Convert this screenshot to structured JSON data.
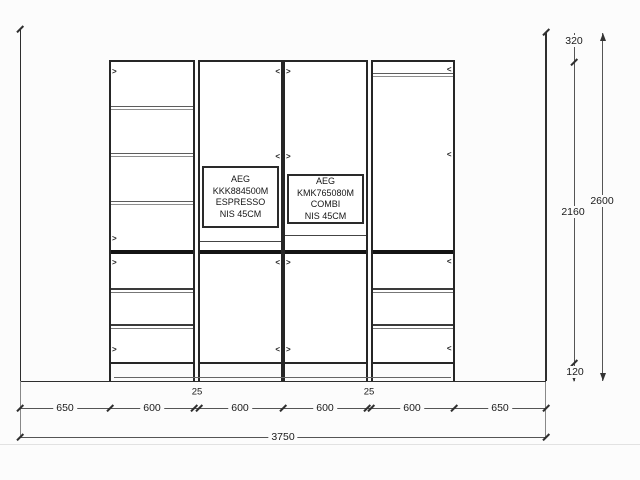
{
  "drawing_type": "kitchen-tall-cabinet-elevation",
  "appliances": [
    {
      "model": "AEG KKK884500M",
      "label": "ESPRESSO",
      "niche": "NIS 45CM"
    },
    {
      "model": "AEG KMK765080M",
      "label": "COMBI",
      "niche": "NIS 45CM"
    }
  ],
  "dims": {
    "top_offset": "320",
    "total_height": "2600",
    "carcass_height": "2160",
    "plinth_height": "120",
    "segments": [
      "650",
      "600",
      "600",
      "600",
      "600",
      "650"
    ],
    "gaps": [
      "25",
      "25"
    ],
    "total_width": "3750"
  },
  "glyphs": {
    "hinge_right": ">",
    "hinge_left": "<"
  },
  "colors": {
    "line": "#2e2e2e",
    "divider": "#141414",
    "background": "#fcfcfc",
    "text": "#1b1b1b"
  }
}
